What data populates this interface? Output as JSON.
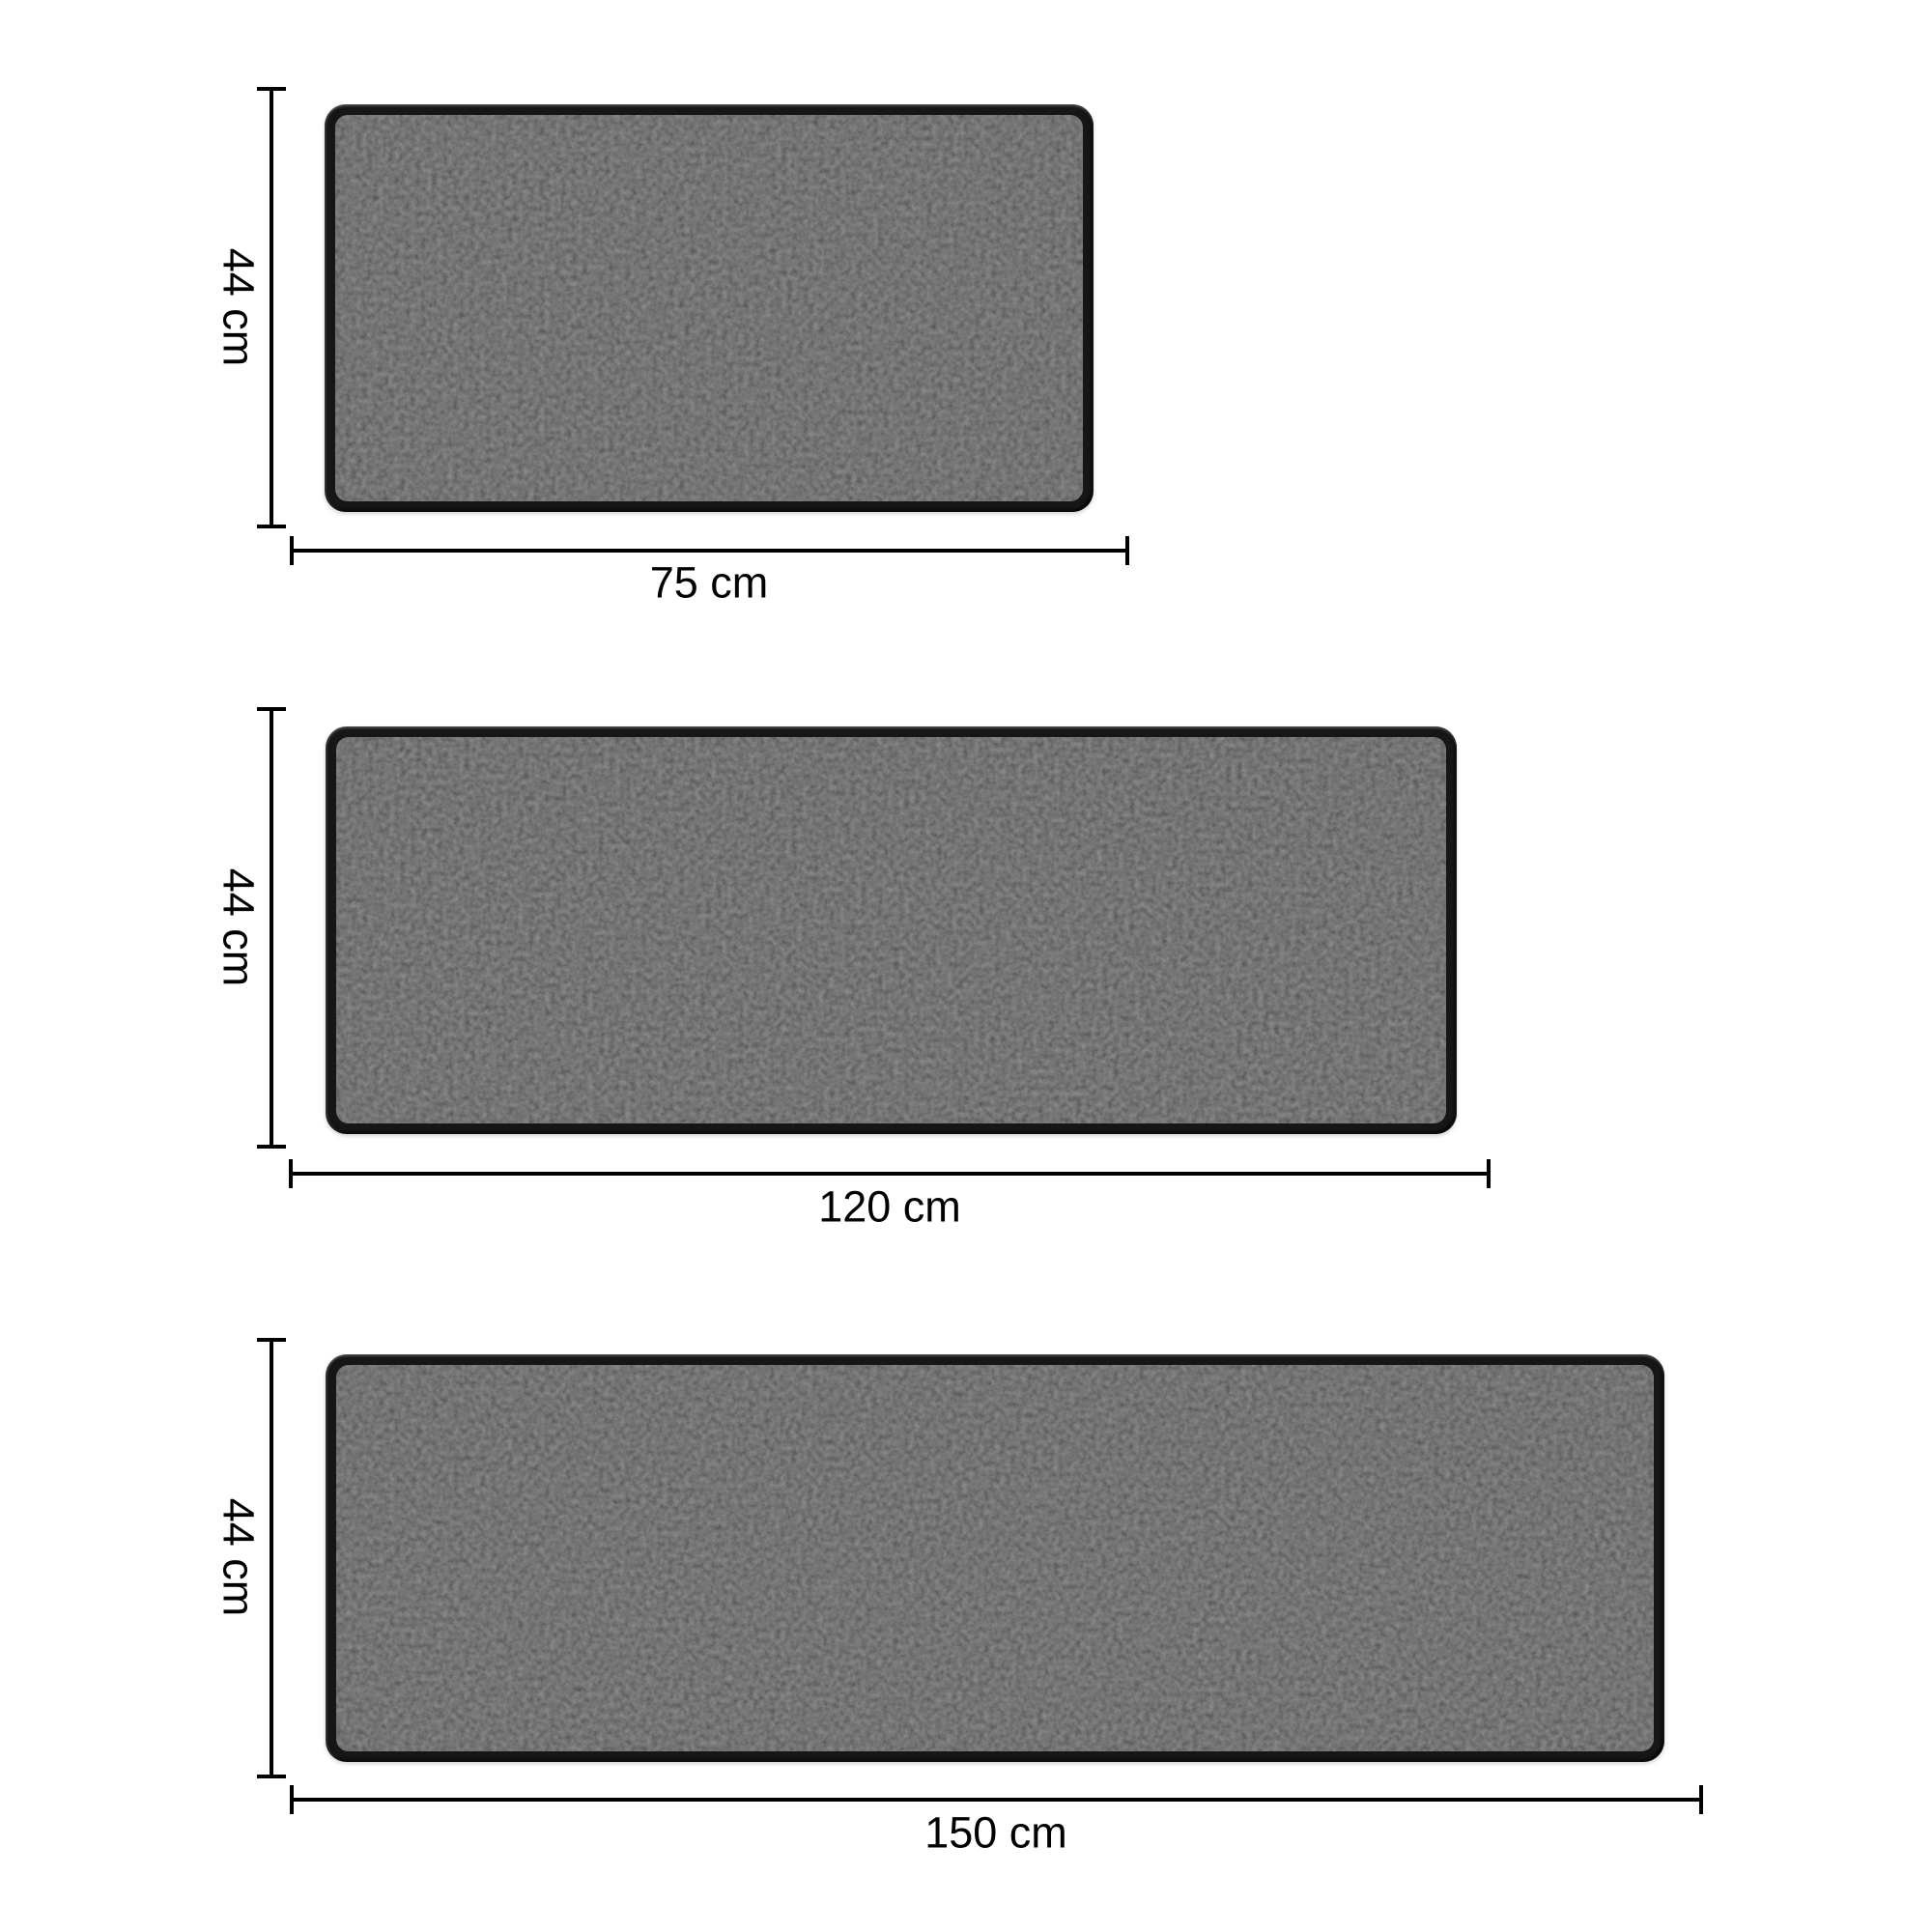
{
  "page": {
    "background_color": "#ffffff",
    "line_color": "#000000",
    "text_color": "#000000",
    "mat_color": "#1a1a1a"
  },
  "mats": [
    {
      "name": "kitchen-mat-small",
      "width_cm": 75,
      "height_cm": 44,
      "width_label": "75 cm",
      "height_label": "44 cm"
    },
    {
      "name": "kitchen-mat-medium",
      "width_cm": 120,
      "height_cm": 44,
      "width_label": "120 cm",
      "height_label": "44 cm"
    },
    {
      "name": "kitchen-mat-large",
      "width_cm": 150,
      "height_cm": 44,
      "width_label": "150 cm",
      "height_label": "44 cm"
    }
  ]
}
